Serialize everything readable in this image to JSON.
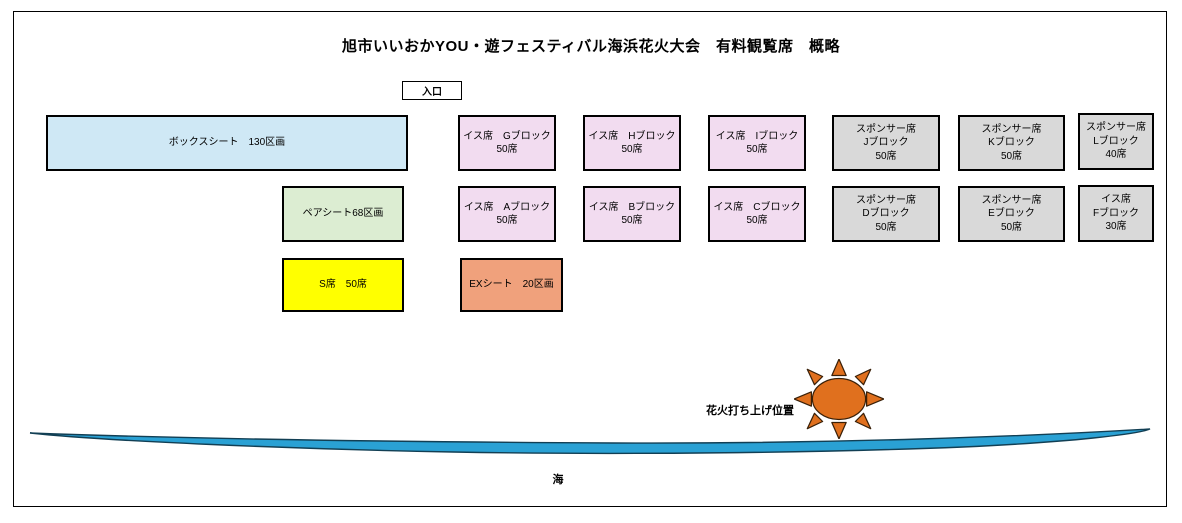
{
  "title": "旭市いいおかYOU・遊フェスティバル海浜花火大会　有料観覧席　概略",
  "entrance": {
    "label": "入口"
  },
  "seats": [
    {
      "id": "box-sheet",
      "kind": "box-sheet",
      "lines": [
        "ボックスシート　130区画"
      ]
    },
    {
      "id": "chair-g",
      "kind": "chair-seat",
      "lines": [
        "イス席　Gブロック",
        "50席"
      ]
    },
    {
      "id": "chair-h",
      "kind": "chair-seat",
      "lines": [
        "イス席　Hブロック",
        "50席"
      ]
    },
    {
      "id": "chair-i",
      "kind": "chair-seat",
      "lines": [
        "イス席　Iブロック",
        "50席"
      ]
    },
    {
      "id": "sponsor-j",
      "kind": "sponsor-seat",
      "lines": [
        "スポンサー席",
        "Jブロック",
        "50席"
      ]
    },
    {
      "id": "sponsor-k",
      "kind": "sponsor-seat",
      "lines": [
        "スポンサー席",
        "Kブロック",
        "50席"
      ]
    },
    {
      "id": "sponsor-l",
      "kind": "sponsor-seat",
      "lines": [
        "スポンサー席",
        "Lブロック",
        "40席"
      ]
    },
    {
      "id": "pair-sheet",
      "kind": "pair-sheet",
      "lines": [
        "ペアシート68区画"
      ]
    },
    {
      "id": "chair-a",
      "kind": "chair-seat",
      "lines": [
        "イス席　Aブロック",
        "50席"
      ]
    },
    {
      "id": "chair-b",
      "kind": "chair-seat",
      "lines": [
        "イス席　Bブロック",
        "50席"
      ]
    },
    {
      "id": "chair-c",
      "kind": "chair-seat",
      "lines": [
        "イス席　Cブロック",
        "50席"
      ]
    },
    {
      "id": "sponsor-d",
      "kind": "sponsor-seat",
      "lines": [
        "スポンサー席",
        "Dブロック",
        "50席"
      ]
    },
    {
      "id": "sponsor-e",
      "kind": "sponsor-seat",
      "lines": [
        "スポンサー席",
        "Eブロック",
        "50席"
      ]
    },
    {
      "id": "chair-f",
      "kind": "chair-seat",
      "lines": [
        "イス席",
        "Fブロック",
        "30席"
      ]
    },
    {
      "id": "s-seat",
      "kind": "s-seat",
      "lines": [
        "S席　50席"
      ]
    },
    {
      "id": "ex-sheet",
      "kind": "ex-sheet",
      "lines": [
        "EXシート　20区画"
      ]
    }
  ],
  "fireworks": {
    "label": "花火打ち上げ位置"
  },
  "sea": {
    "label": "海"
  },
  "colors": {
    "box_sheet": "#cfe8f5",
    "chair_seat": "#f2dcf0",
    "sponsor_seat": "#d9d9d9",
    "pair_sheet": "#dcedd2",
    "s_seat": "#ffff00",
    "ex_sheet": "#f0a17c",
    "sun": "#e0701e",
    "sea": "#2aa1d4"
  }
}
